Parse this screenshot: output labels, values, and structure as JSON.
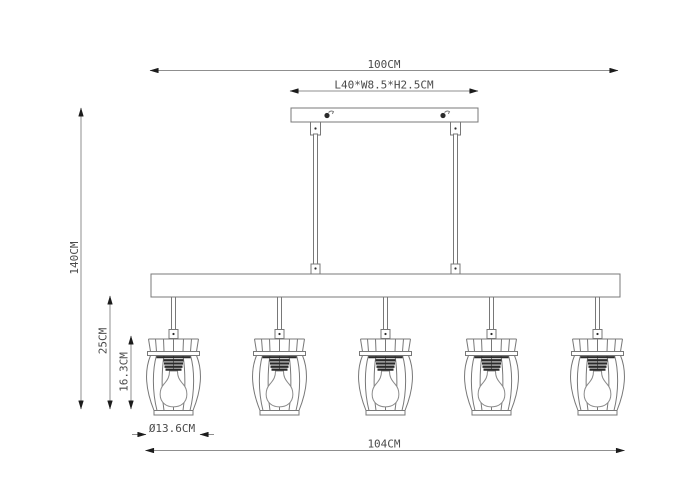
{
  "drawing": {
    "type": "pendant-light-dimension-diagram",
    "lamp_count": 5,
    "labels": {
      "overall_width": "100CM",
      "canopy_size": "L40*W8.5*H2.5CM",
      "overall_height": "140CM",
      "hanging_height": "25CM",
      "shade_height": "16.3CM",
      "shade_diameter": "Ø13.6CM",
      "fixture_length": "104CM"
    },
    "colors": {
      "background": "#ffffff",
      "line": "#8f8f8f",
      "outline": "#787878",
      "dark_detail": "#2b2b2b",
      "text": "#4a4a4a",
      "arrow": "#1c1c1c"
    }
  }
}
